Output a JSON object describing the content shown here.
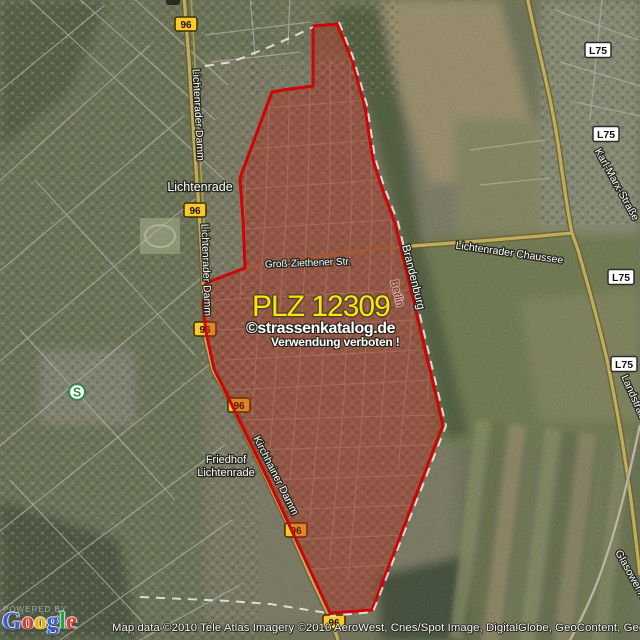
{
  "title": {
    "plz": "PLZ 12309",
    "watermark": "©strassenkatalog.de",
    "warning": "Verwendung verboten !"
  },
  "colors": {
    "overlay_fill": "#b5281c",
    "overlay_stroke": "#cf0404",
    "border_dash": "#ffffff",
    "shield_b96_bg": "#fcc92d",
    "shield_l75_bg": "#ffffff",
    "plz_text": "#ffe400",
    "sbahn_green": "#2e8b46"
  },
  "street_labels": [
    {
      "id": "city-lichtenrade",
      "text": "Lichtenrade",
      "x": 200,
      "y": 191,
      "rot": 0,
      "size": 12.5
    },
    {
      "id": "friedhof-line1",
      "text": "Friedhof",
      "x": 226,
      "y": 463,
      "rot": 0,
      "size": 11
    },
    {
      "id": "friedhof-line2",
      "text": "Lichtenrade",
      "x": 226,
      "y": 476,
      "rot": 0,
      "size": 11
    },
    {
      "id": "gross-ziethener-str",
      "text": "Groß-Ziethener Str.",
      "x": 308,
      "y": 266,
      "rot": -2,
      "size": 10
    },
    {
      "id": "lichtenrader-chaussee",
      "text": "Lichtenrader Chaussee",
      "x": 509,
      "y": 256,
      "rot": 8,
      "size": 10.5
    },
    {
      "id": "karl-marx-strasse",
      "text": "Karl-Marx-Straße",
      "x": 614,
      "y": 186,
      "rot": 61,
      "size": 10.5
    },
    {
      "id": "landstrasse",
      "text": "Landstraße",
      "x": 632,
      "y": 401,
      "rot": 66,
      "size": 10.5
    },
    {
      "id": "glasower-allee",
      "text": "Glasower Allee",
      "x": 632,
      "y": 583,
      "rot": 61,
      "size": 10.5
    },
    {
      "id": "brandenburg",
      "text": "Brandenburg",
      "x": 410,
      "y": 278,
      "rot": 76,
      "size": 11.5
    },
    {
      "id": "berlin",
      "text": "Berlin",
      "x": 394,
      "y": 294,
      "rot": 76,
      "size": 10.5,
      "fill": "#6d2a1e",
      "halo": "rgba(250,225,210,0.45)"
    },
    {
      "id": "lichtenrader-damm-nord",
      "text": "Lichtenrader Damm",
      "x": 195,
      "y": 115,
      "rot": 87,
      "size": 10.5
    },
    {
      "id": "lichtenrader-damm-sued",
      "text": "Lichtenrader Damm",
      "x": 203,
      "y": 270,
      "rot": 88,
      "size": 10.5
    },
    {
      "id": "kirchhainer-damm",
      "text": "Kirchhainer Damm",
      "x": 273,
      "y": 477,
      "rot": 63,
      "size": 10.5
    }
  ],
  "shields": {
    "b96": {
      "label": "96",
      "positions": [
        {
          "x": 186,
          "y": 24
        },
        {
          "x": 195,
          "y": 210
        },
        {
          "x": 205,
          "y": 329
        },
        {
          "x": 239,
          "y": 405
        },
        {
          "x": 296,
          "y": 530
        },
        {
          "x": 334,
          "y": 622
        }
      ]
    },
    "l75": {
      "label": "L75",
      "positions": [
        {
          "x": 598,
          "y": 50
        },
        {
          "x": 606,
          "y": 134
        },
        {
          "x": 621,
          "y": 277
        },
        {
          "x": 624,
          "y": 364
        }
      ]
    }
  },
  "transit": {
    "sbahn_label": "S",
    "x": 77,
    "y": 392
  },
  "attribution": "Map data ©2010 Tele Atlas  Imagery ©2010 AeroWest, Cnes/Spot Image, DigitalGlobe, GeoContent, GeoEye",
  "google_logo": {
    "powered_by": "POWERED BY",
    "letters": [
      {
        "ch": "G",
        "color": "#3b5bd1"
      },
      {
        "ch": "o",
        "color": "#d73d32"
      },
      {
        "ch": "o",
        "color": "#f0b400"
      },
      {
        "ch": "g",
        "color": "#3b5bd1"
      },
      {
        "ch": "l",
        "color": "#27a04a"
      },
      {
        "ch": "e",
        "color": "#d73d32"
      }
    ]
  }
}
